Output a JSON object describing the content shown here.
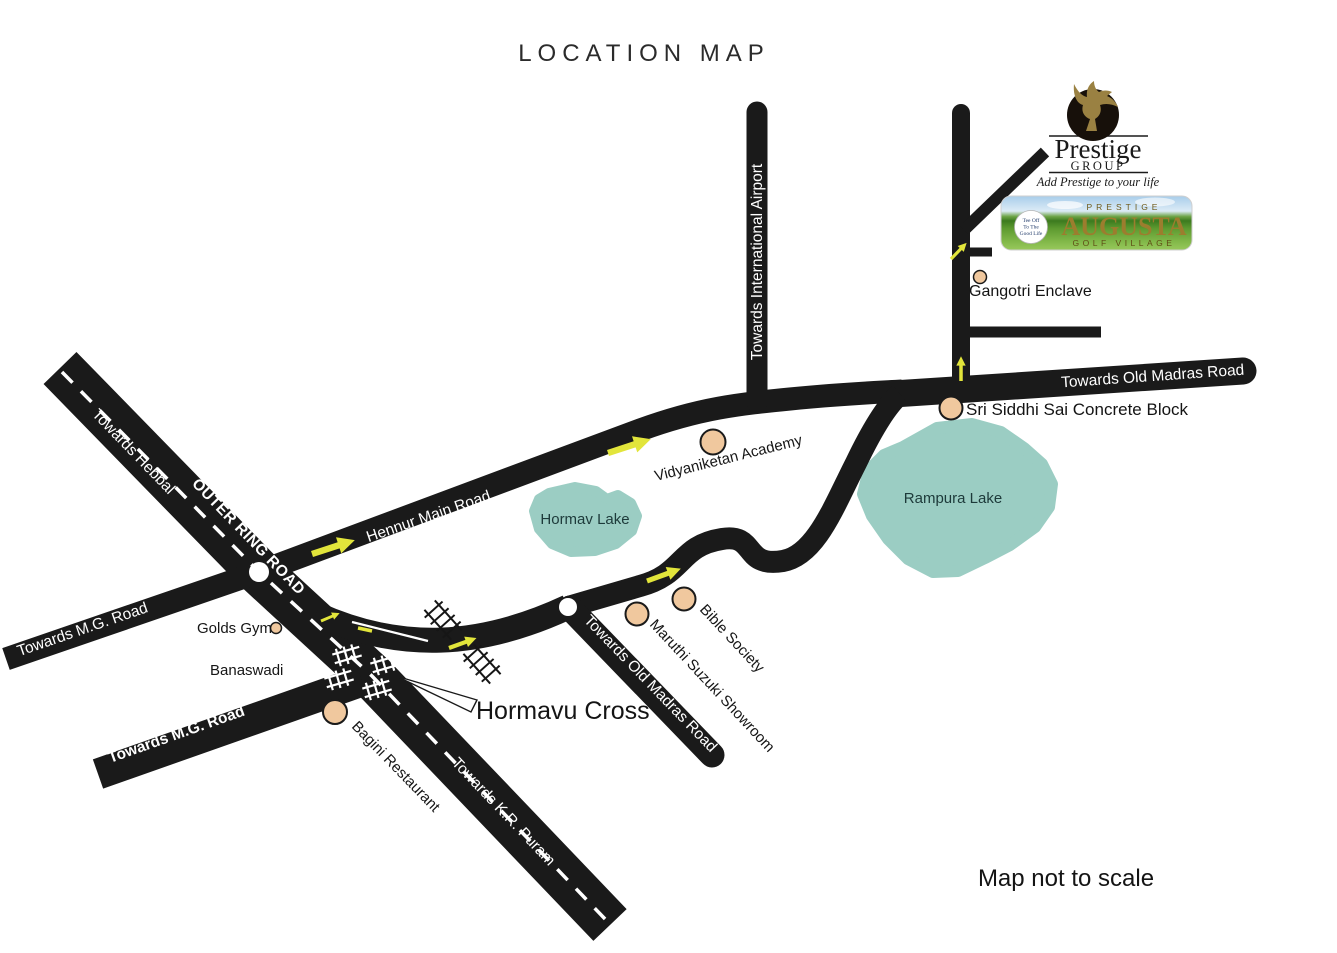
{
  "title": "LOCATION MAP",
  "note": "Map not to scale",
  "colors": {
    "road": "#1a1a1a",
    "lake": "#9bcdc3",
    "landmark": "#f0c89e",
    "arrow": "#e2e53b",
    "brand_gold": "#9c7d2e"
  },
  "roads": {
    "hebbal": "Towards Hebbal",
    "outer_ring": "OUTER RING ROAD",
    "kr_puram": "Towards K.R. Puram",
    "mg_upper": "Towards M.G. Road",
    "mg_lower": "Towards M.G. Road",
    "hennur": "Hennur Main Road",
    "airport": "Towards International Airport",
    "old_madras_top": "Towards Old Madras Road",
    "old_madras_diag": "Towards Old Madras Road"
  },
  "lakes": {
    "hormav": "Hormav Lake",
    "rampura": "Rampura Lake"
  },
  "landmarks": {
    "golds_gym": "Golds Gym",
    "banaswadi": "Banaswadi",
    "bagini": "Bagini Restaurant",
    "hormavu_cross": "Hormavu Cross",
    "maruthi": "Maruthi Suzuki Showroom",
    "bible": "Bible Society",
    "vidyaniketan": "Vidyaniketan Academy",
    "sri_siddhi": "Sri Siddhi Sai Concrete Block",
    "gangotri": "Gangotri Enclave"
  },
  "logo": {
    "brand": "Prestige",
    "group": "GROUP",
    "tagline": "Add Prestige to your life",
    "banner": {
      "prestige": "PRESTIGE",
      "name": "AUGUSTA",
      "subtitle": "GOLF VILLAGE",
      "ball1": "Tee Off",
      "ball2": "To The",
      "ball3": "Good Life"
    }
  }
}
